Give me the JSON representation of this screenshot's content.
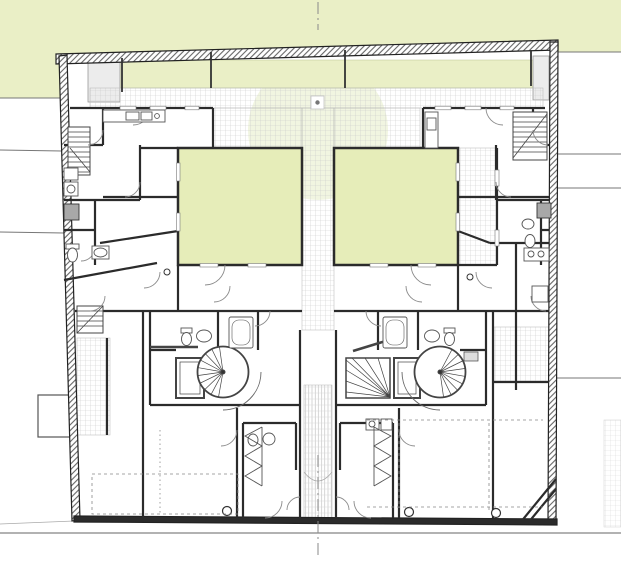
{
  "meta": {
    "drawing_type": "architectural ground-floor plan",
    "description": "Two mirrored dwelling units arranged symmetrically about a central axis, each wrapping a private green courtyard; tiled walkways, spiral stairs with lift shafts, bathrooms, garden band along the top, neighbor parcel lines and street edge at bottom",
    "visible_text": []
  },
  "colors": {
    "background": "#ffffff",
    "garden_green": "#eaefc6",
    "courtyard_green": "#e6edb9",
    "canopy_green": "#e3ecc4",
    "planter_gray": "#ececec",
    "wall_dark": "#2b2b2b",
    "line_medium": "#555555",
    "line_light": "#999999",
    "grid_line": "#c9c9c9",
    "shower_gray": "#a8a8a8"
  },
  "site": {
    "neighbor_lines_left": 2,
    "neighbor_lines_right": 4,
    "street_line": true,
    "center_axis_line": true,
    "left_annex_rectangle": true
  },
  "building": {
    "units": 2,
    "green_courtyards": 2,
    "spiral_staircases": 2,
    "elevator_shafts": 2,
    "straight_stairs": 3,
    "winder_stairs": 1,
    "bathtubs": 2,
    "shower_stalls": 2,
    "columns": 3,
    "wardrobes": 2
  }
}
